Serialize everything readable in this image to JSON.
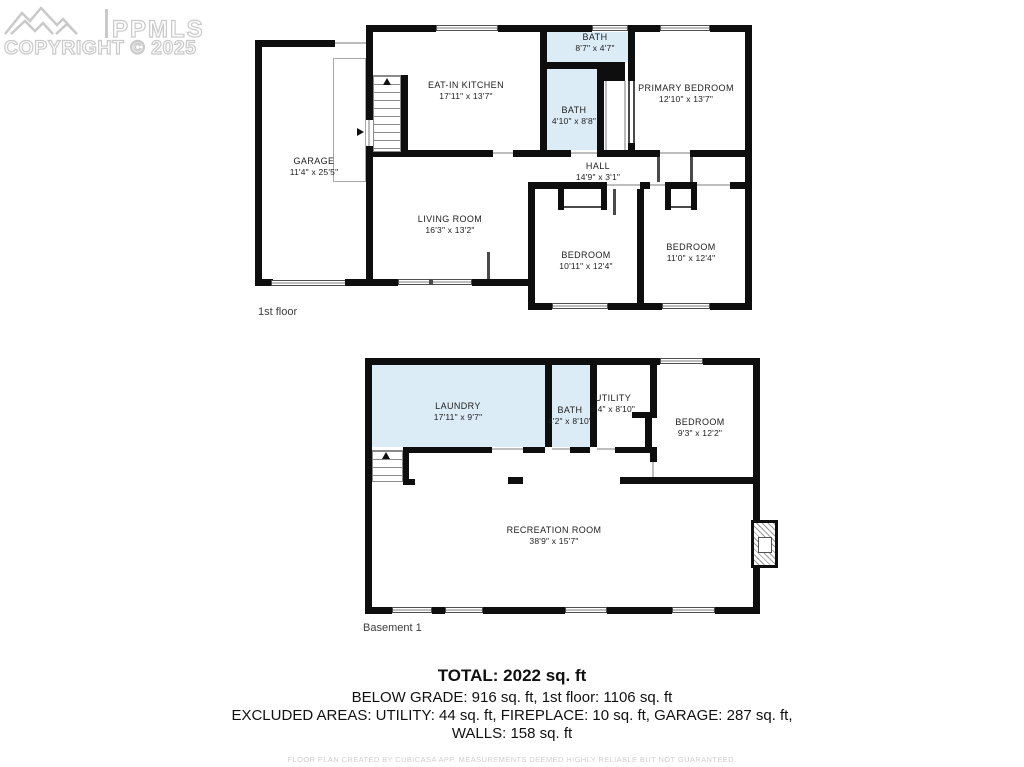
{
  "logo": {
    "brand": "PPMLS",
    "copyright": "COPYRIGHT © 2025"
  },
  "colors": {
    "wall": "#0e0e0e",
    "wet_room_fill": "#dcecf7",
    "logo_gray": "#c9c9c9"
  },
  "floors": [
    {
      "label": "1st floor",
      "rooms": [
        {
          "name": "GARAGE",
          "dims": "11'4\" x 25'5\""
        },
        {
          "name": "EAT-IN KITCHEN",
          "dims": "17'11\" x 13'7\""
        },
        {
          "name": "BATH",
          "dims": "8'7\" x 4'7\""
        },
        {
          "name": "BATH",
          "dims": "4'10\" x 8'8\""
        },
        {
          "name": "PRIMARY BEDROOM",
          "dims": "12'10\" x 13'7\""
        },
        {
          "name": "HALL",
          "dims": "14'9\" x 3'1\""
        },
        {
          "name": "LIVING ROOM",
          "dims": "16'3\" x 13'2\""
        },
        {
          "name": "BEDROOM",
          "dims": "10'11\" x 12'4\""
        },
        {
          "name": "BEDROOM",
          "dims": "11'0\" x 12'4\""
        }
      ]
    },
    {
      "label": "Basement 1",
      "rooms": [
        {
          "name": "LAUNDRY",
          "dims": "17'11\" x 9'7\""
        },
        {
          "name": "BATH",
          "dims": "4'2\" x 8'10\""
        },
        {
          "name": "UTILITY",
          "dims": "6'4\" x 8'10\""
        },
        {
          "name": "BEDROOM",
          "dims": "9'3\" x 12'2\""
        },
        {
          "name": "RECREATION ROOM",
          "dims": "38'9\" x 15'7\""
        }
      ]
    }
  ],
  "summary": {
    "total": "TOTAL: 2022 sq. ft",
    "line2": "BELOW GRADE: 916 sq. ft, 1st floor: 1106 sq. ft",
    "line3": "EXCLUDED AREAS: UTILITY: 44 sq. ft, FIREPLACE: 10 sq. ft, GARAGE: 287 sq. ft,",
    "line4": "WALLS: 158 sq. ft"
  },
  "disclaimer": "FLOOR PLAN CREATED BY CUBICASA APP. MEASUREMENTS DEEMED HIGHLY RELIABLE BUT NOT GUARANTEED."
}
